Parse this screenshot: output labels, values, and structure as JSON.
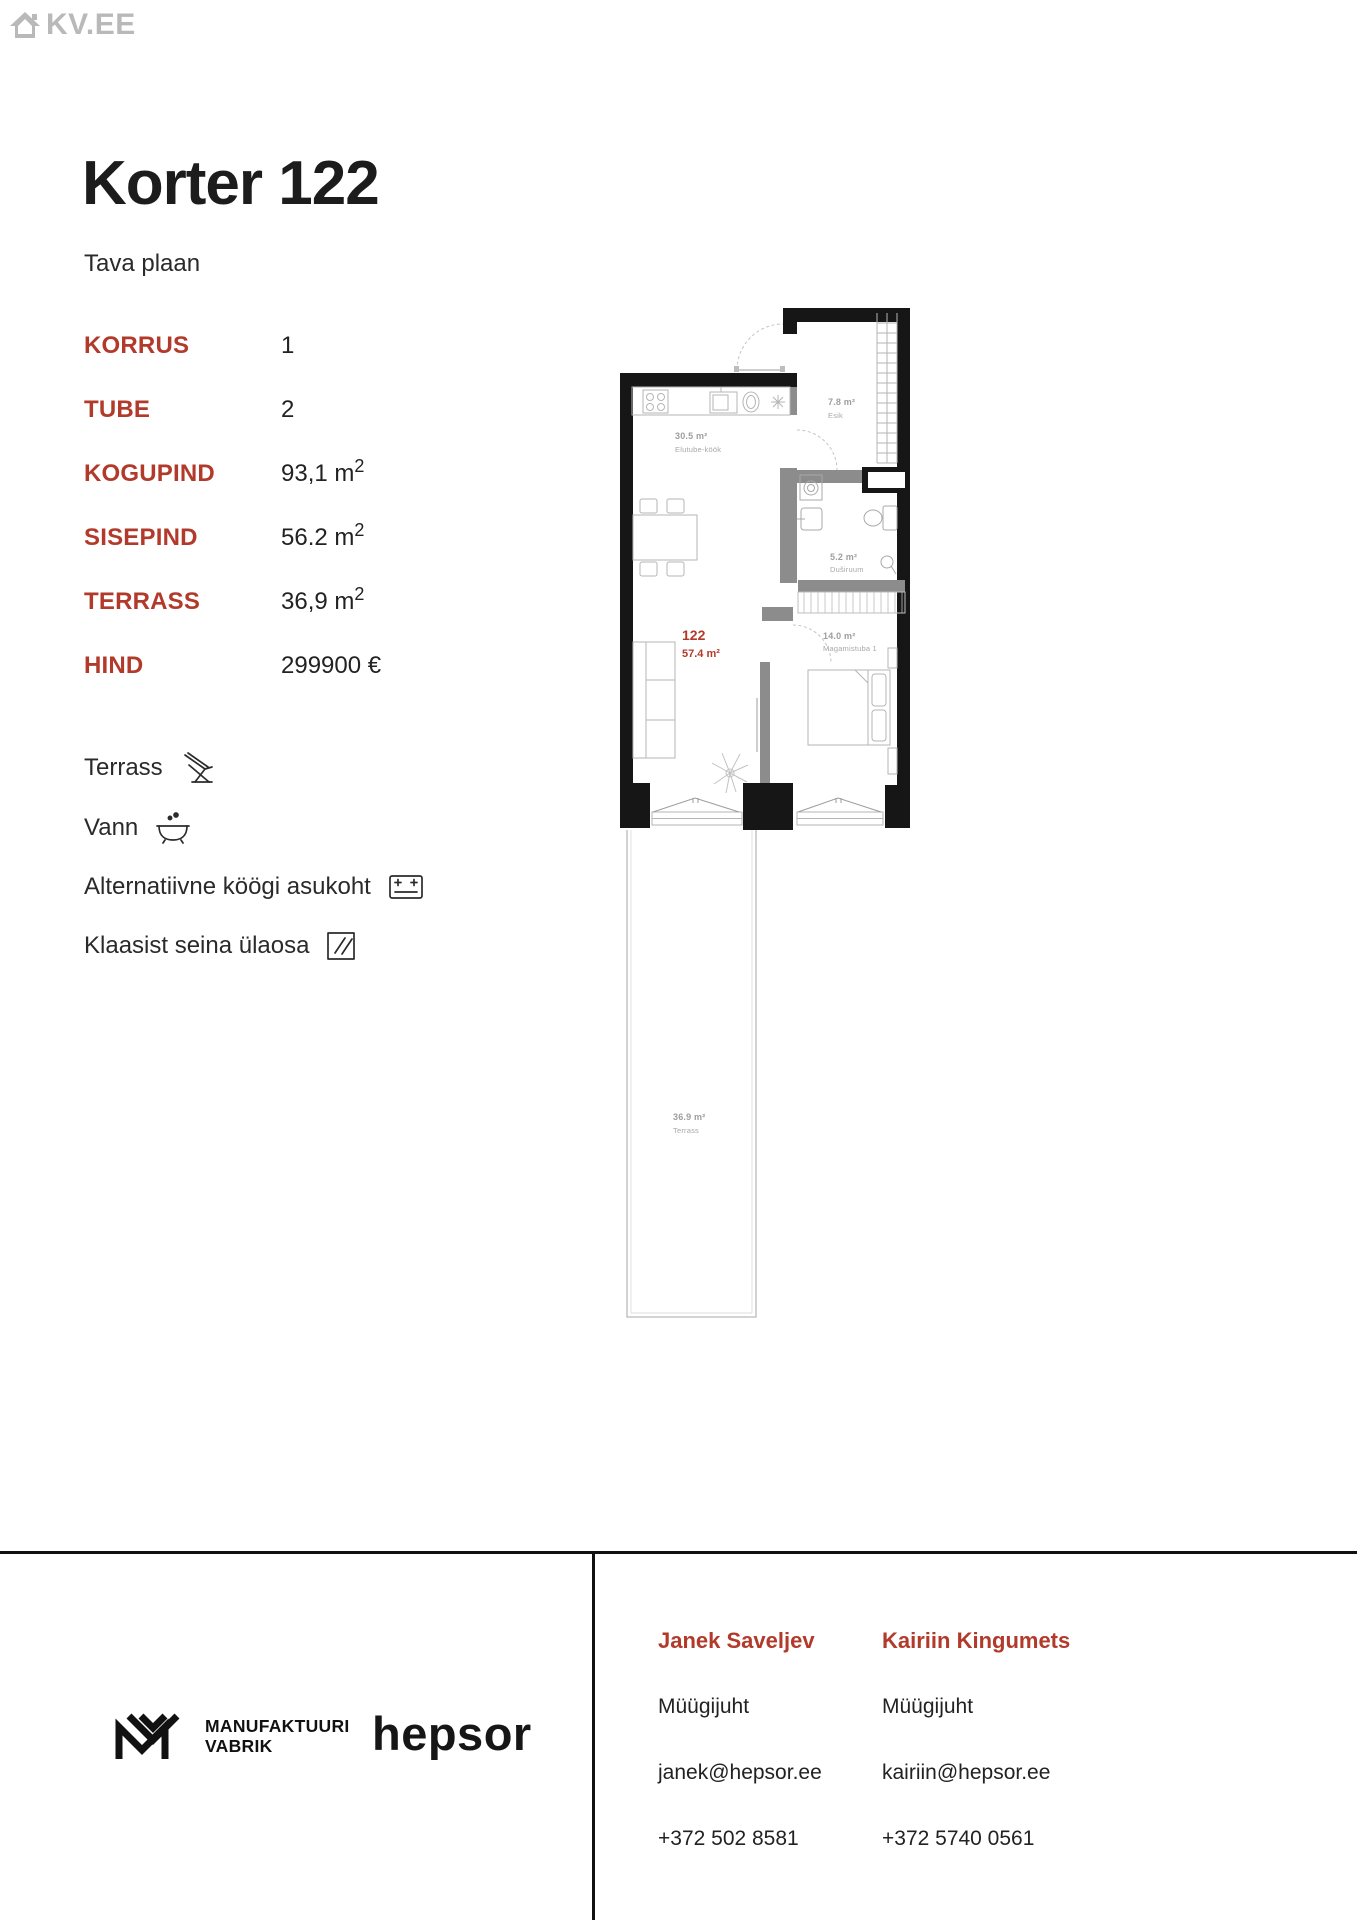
{
  "colors": {
    "accent": "#b23a2b",
    "logo_gray": "#b9b9b9",
    "wall_black": "#161616",
    "plan_label_gray": "#9e9e9e"
  },
  "logo": {
    "text": "KV.EE"
  },
  "header": {
    "title": "Korter 122",
    "subtitle": "Tava plaan"
  },
  "details": {
    "rows": [
      {
        "label": "KORRUS",
        "value": "1",
        "sup": ""
      },
      {
        "label": "TUBE",
        "value": "2",
        "sup": ""
      },
      {
        "label": "KOGUPIND",
        "value": "93,1 m",
        "sup": "2"
      },
      {
        "label": "SISEPIND",
        "value": "56.2 m",
        "sup": "2"
      },
      {
        "label": "TERRASS",
        "value": "36,9 m",
        "sup": "2"
      },
      {
        "label": "HIND",
        "value": "299900 €",
        "sup": ""
      }
    ]
  },
  "features": [
    {
      "label": "Terrass",
      "icon": "deck-chair-icon"
    },
    {
      "label": "Vann",
      "icon": "bathtub-icon"
    },
    {
      "label": "Alternatiivne köögi asukoht",
      "icon": "stove-icon"
    },
    {
      "label": "Klaasist seina ülaosa",
      "icon": "glass-wall-icon"
    }
  ],
  "floorplan": {
    "unit_number": "122",
    "unit_area": "57.4 m²",
    "rooms": [
      {
        "area": "30.5 m²",
        "name": "Elutube-köök"
      },
      {
        "area": "7.8 m²",
        "name": "Esik"
      },
      {
        "area": "5.2 m²",
        "name": "Duširuum"
      },
      {
        "area": "14.0 m²",
        "name": "Magamistuba 1"
      },
      {
        "area": "36.9 m²",
        "name": "Terrass"
      }
    ]
  },
  "footer": {
    "brand1": {
      "line1": "MANUFAKTUURI",
      "line2": "VABRIK"
    },
    "brand2": "hepsor",
    "contacts": [
      {
        "name": "Janek Saveljev",
        "role": "Müügijuht",
        "email": "janek@hepsor.ee",
        "phone": "+372 502 8581"
      },
      {
        "name": "Kairiin Kingumets",
        "role": "Müügijuht",
        "email": "kairiin@hepsor.ee",
        "phone": "+372 5740 0561"
      }
    ]
  }
}
